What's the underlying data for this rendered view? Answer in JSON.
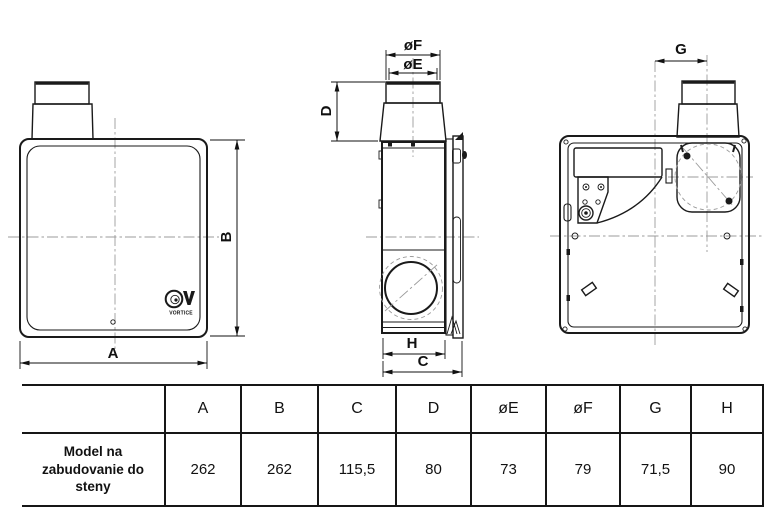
{
  "drawing": {
    "front_view": {
      "width_label": "A",
      "height_label": "B",
      "logo_text": "VORTICE"
    },
    "side_view": {
      "outer_diameter_label": "øF",
      "inner_diameter_label": "øE",
      "duct_height_label": "D",
      "body_depth_label": "H",
      "total_depth_label": "C"
    },
    "rear_view": {
      "duct_offset_label": "G"
    }
  },
  "table": {
    "row_header": "Model na zabudovanie do steny",
    "columns": [
      "A",
      "B",
      "C",
      "D",
      "øE",
      "øF",
      "G",
      "H"
    ],
    "values": [
      "262",
      "262",
      "115,5",
      "80",
      "73",
      "79",
      "71,5",
      "90"
    ]
  },
  "colors": {
    "line": "#1a1a1a",
    "centerline": "#9b9b9b",
    "background": "#ffffff"
  }
}
